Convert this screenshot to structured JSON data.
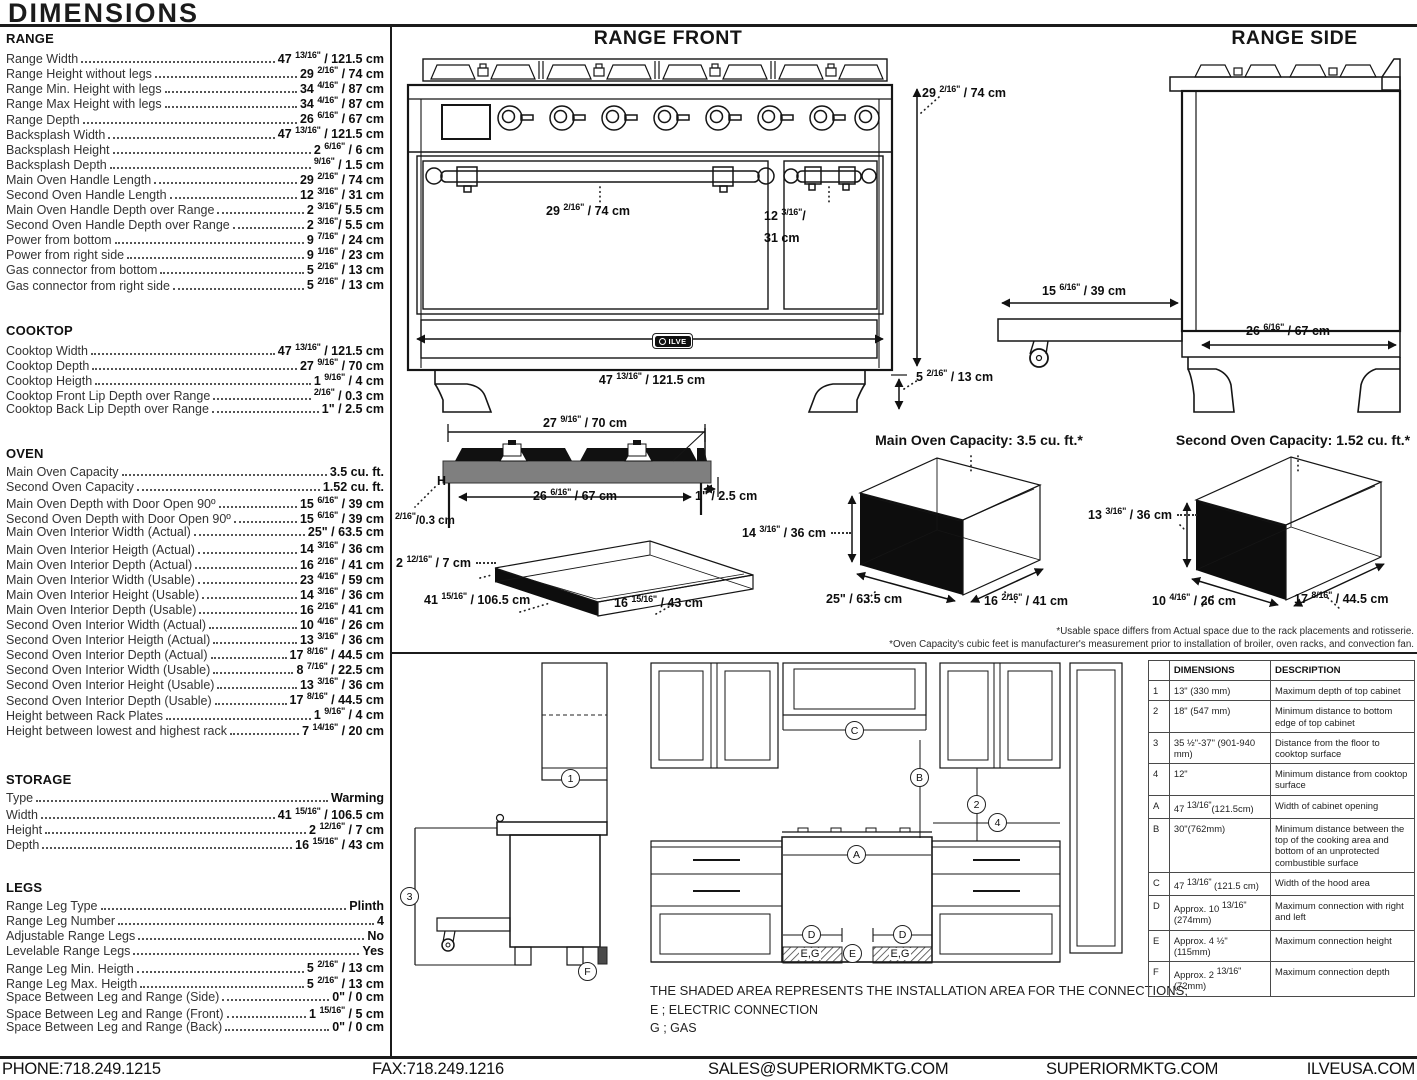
{
  "header": {
    "title": "DIMENSIONS"
  },
  "specs": {
    "sections": [
      {
        "heading": "RANGE",
        "rows": [
          {
            "label": "Range Width",
            "value": "47 13/16\" / 121.5 cm"
          },
          {
            "label": "Range Height without legs",
            "value": "29 2/16\" / 74 cm"
          },
          {
            "label": "Range Min. Height with legs",
            "value": "34 4/16\" / 87 cm"
          },
          {
            "label": "Range Max Height with legs",
            "value": "34 4/16\" / 87 cm"
          },
          {
            "label": "Range Depth",
            "value": "26 6/16\" / 67 cm"
          },
          {
            "label": "Backsplash Width",
            "value": "47 13/16\" / 121.5 cm"
          },
          {
            "label": "Backsplash Height",
            "value": "2 6/16\" / 6 cm"
          },
          {
            "label": "Backsplash Depth",
            "value": "9/16\" / 1.5 cm"
          },
          {
            "label": "Main Oven Handle Length",
            "value": "29 2/16\" / 74 cm"
          },
          {
            "label": "Second Oven Handle Length",
            "value": "12 3/16\" / 31 cm"
          },
          {
            "label": "Main Oven Handle Depth over Range",
            "value": "2 3/16\"/ 5.5 cm"
          },
          {
            "label": "Second Oven Handle Depth over Range",
            "value": "2 3/16\"/ 5.5 cm"
          },
          {
            "label": "Power from bottom",
            "value": "9 7/16\" / 24 cm"
          },
          {
            "label": "Power from right side",
            "value": "9 1/16\" / 23 cm"
          },
          {
            "label": "Gas connector from bottom",
            "value": "5 2/16\" / 13 cm"
          },
          {
            "label": "Gas connector from right side",
            "value": "5 2/16\" / 13 cm"
          }
        ]
      },
      {
        "heading": "COOKTOP",
        "rows": [
          {
            "label": "Cooktop Width",
            "value": "47 13/16\" / 121.5 cm"
          },
          {
            "label": "Cooktop Depth",
            "value": "27 9/16\" / 70 cm"
          },
          {
            "label": "Cooktop Heigth",
            "value": "1 9/16\" / 4 cm"
          },
          {
            "label": "Cooktop Front Lip Depth over Range",
            "value": "2/16\" / 0.3 cm"
          },
          {
            "label": "Cooktop Back Lip Depth over Range",
            "value": "1\" / 2.5 cm"
          }
        ]
      },
      {
        "heading": "OVEN",
        "rows": [
          {
            "label": "Main Oven Capacity",
            "value": "3.5 cu. ft."
          },
          {
            "label": "Second Oven Capacity",
            "value": "1.52 cu. ft."
          },
          {
            "label": "Main Oven Depth with Door Open 90º",
            "value": "15 6/16\" / 39 cm"
          },
          {
            "label": "Second Oven Depth with Door Open 90º",
            "value": "15 6/16\" / 39 cm"
          },
          {
            "label": "Main Oven Interior Width (Actual)",
            "value": "25\" / 63.5 cm"
          },
          {
            "label": "Main Oven Interior Heigth (Actual)",
            "value": "14 3/16\" / 36 cm"
          },
          {
            "label": "Main Oven Interior Depth (Actual)",
            "value": "16 2/16\" / 41 cm"
          },
          {
            "label": "Main Oven Interior Width (Usable)",
            "value": "23 4/16\" / 59 cm"
          },
          {
            "label": "Main Oven Interior Height (Usable)",
            "value": "14 3/16\" / 36 cm"
          },
          {
            "label": "Main Oven Interior Depth (Usable)",
            "value": "16 2/16\" / 41 cm"
          },
          {
            "label": "Second Oven Interior Width (Actual)",
            "value": "10 4/16\" / 26 cm"
          },
          {
            "label": "Second Oven Interior Heigth (Actual)",
            "value": "13 3/16\" / 36 cm"
          },
          {
            "label": "Second Oven Interior Depth (Actual)",
            "value": "17 8/16\" / 44.5 cm"
          },
          {
            "label": "Second Oven Interior Width (Usable)",
            "value": "8 7/16\" / 22.5 cm"
          },
          {
            "label": "Second Oven Interior Height (Usable)",
            "value": "13 3/16\" / 36 cm"
          },
          {
            "label": "Second Oven Interior Depth (Usable)",
            "value": "17 8/16\" / 44.5 cm"
          },
          {
            "label": "Height between Rack Plates",
            "value": "1 9/16\" / 4 cm"
          },
          {
            "label": "Height between lowest and highest rack",
            "value": "7 14/16\" / 20 cm"
          }
        ]
      },
      {
        "heading": "STORAGE",
        "rows": [
          {
            "label": "Type",
            "value": "Warming"
          },
          {
            "label": "Width",
            "value": "41 15/16\" / 106.5 cm"
          },
          {
            "label": "Height",
            "value": "2 12/16\" / 7 cm"
          },
          {
            "label": "Depth",
            "value": "16 15/16\" / 43 cm"
          }
        ]
      },
      {
        "heading": "LEGS",
        "rows": [
          {
            "label": "Range Leg Type",
            "value": "Plinth"
          },
          {
            "label": "Range Leg Number",
            "value": "4"
          },
          {
            "label": "Adjustable Range Legs",
            "value": "No"
          },
          {
            "label": "Levelable Range Legs",
            "value": "Yes"
          },
          {
            "label": "Range Leg Min. Heigth",
            "value": "5 2/16\" / 13 cm"
          },
          {
            "label": "Range Leg Max. Heigth",
            "value": "5 2/16\" / 13 cm"
          },
          {
            "label": "Space Between Leg and Range (Side)",
            "value": "0\" / 0 cm"
          },
          {
            "label": "Space Between Leg and Range (Front)",
            "value": "1 15/16\" / 5 cm"
          },
          {
            "label": "Space Between Leg and Range (Back)",
            "value": "0\" / 0 cm"
          }
        ]
      }
    ]
  },
  "front": {
    "title": "RANGE FRONT",
    "handle_main": "29 2/16\" / 74 cm",
    "handle_second_line1": "12 3/16\"/",
    "handle_second_line2": "31 cm",
    "width": "47 13/16\" / 121.5 cm",
    "height": "29 2/16\" / 74 cm",
    "leg_height": "5 2/16\" / 13 cm",
    "logo": "ILVE"
  },
  "side": {
    "title": "RANGE SIDE",
    "door_open": "15 6/16\" / 39 cm",
    "depth": "26 6/16\" / 67 cm"
  },
  "cooktop_profile": {
    "width": "27 9/16\" / 70 cm",
    "inner_width": "26 6/16\" / 67 cm",
    "back_lip": "1\" / 2.5 cm",
    "front_lip": "2/16\"/0.3 cm",
    "h_mark": "H"
  },
  "storage_drawer": {
    "height": "2 12/16\" / 7 cm",
    "width": "41 15/16\" / 106.5 cm",
    "depth": "16 15/16\" / 43 cm"
  },
  "main_oven": {
    "title": "Main Oven Capacity: 3.5 cu. ft.*",
    "height": "14 3/16\" / 36 cm",
    "width": "25\" / 63.5 cm",
    "depth": "16 2/16\" / 41 cm"
  },
  "second_oven": {
    "title": "Second Oven Capacity: 1.52 cu. ft.*",
    "height": "13 3/16\" / 36 cm",
    "width": "10 4/16\" / 26 cm",
    "depth": "17 8/16\" / 44.5 cm"
  },
  "footnotes": [
    "*Usable space differs from Actual space due to the rack placements and rotisserie.",
    "*Oven Capacity's cubic feet is manufacturer's measurement prior to installation of broiler, oven racks, and convection fan."
  ],
  "installation": {
    "markers": [
      "1",
      "3",
      "F",
      "C",
      "B",
      "2",
      "4",
      "A",
      "D",
      "D",
      "E"
    ],
    "eg_label": "E,G",
    "note": "THE SHADED AREA REPRESENTS THE INSTALLATION AREA FOR THE CONNECTIONS;",
    "legend": [
      "E ; ELECTRIC CONNECTION",
      "G ; GAS"
    ]
  },
  "table": {
    "headers": [
      "",
      "DIMENSIONS",
      "DESCRIPTION"
    ],
    "rows": [
      {
        "key": "1",
        "dim": "13\" (330 mm)",
        "desc": "Maximum depth of top cabinet"
      },
      {
        "key": "2",
        "dim": "18\" (547 mm)",
        "desc": "Minimum distance to bottom edge of top cabinet"
      },
      {
        "key": "3",
        "dim": "35 ½\"-37\" (901-940 mm)",
        "desc": "Distance from the floor to cooktop surface"
      },
      {
        "key": "4",
        "dim": "12\"",
        "desc": "Minimum distance from cooktop surface"
      },
      {
        "key": "A",
        "dim": "47 13/16\"(121.5cm)",
        "desc": "Width of cabinet opening"
      },
      {
        "key": "B",
        "dim": "30\"(762mm)",
        "desc": "Minimum distance between the top of the cooking area and bottom of an unprotected combustible surface"
      },
      {
        "key": "C",
        "dim": "47 13/16\" (121.5 cm)",
        "desc": "Width of the hood area"
      },
      {
        "key": "D",
        "dim": "Approx. 10 13/16\" (274mm)",
        "desc": "Maximum connection with right and left"
      },
      {
        "key": "E",
        "dim": "Approx. 4 ½\" (115mm)",
        "desc": "Maximum connection height"
      },
      {
        "key": "F",
        "dim": "Approx. 2 13/16\" (72mm)",
        "desc": "Maximum connection depth"
      }
    ]
  },
  "footer": {
    "items": [
      "PHONE:718.249.1215",
      "FAX:718.249.1216",
      "SALES@SUPERIORMKTG.COM",
      "SUPERIORMKTG.COM",
      "ILVEUSA.COM"
    ]
  }
}
